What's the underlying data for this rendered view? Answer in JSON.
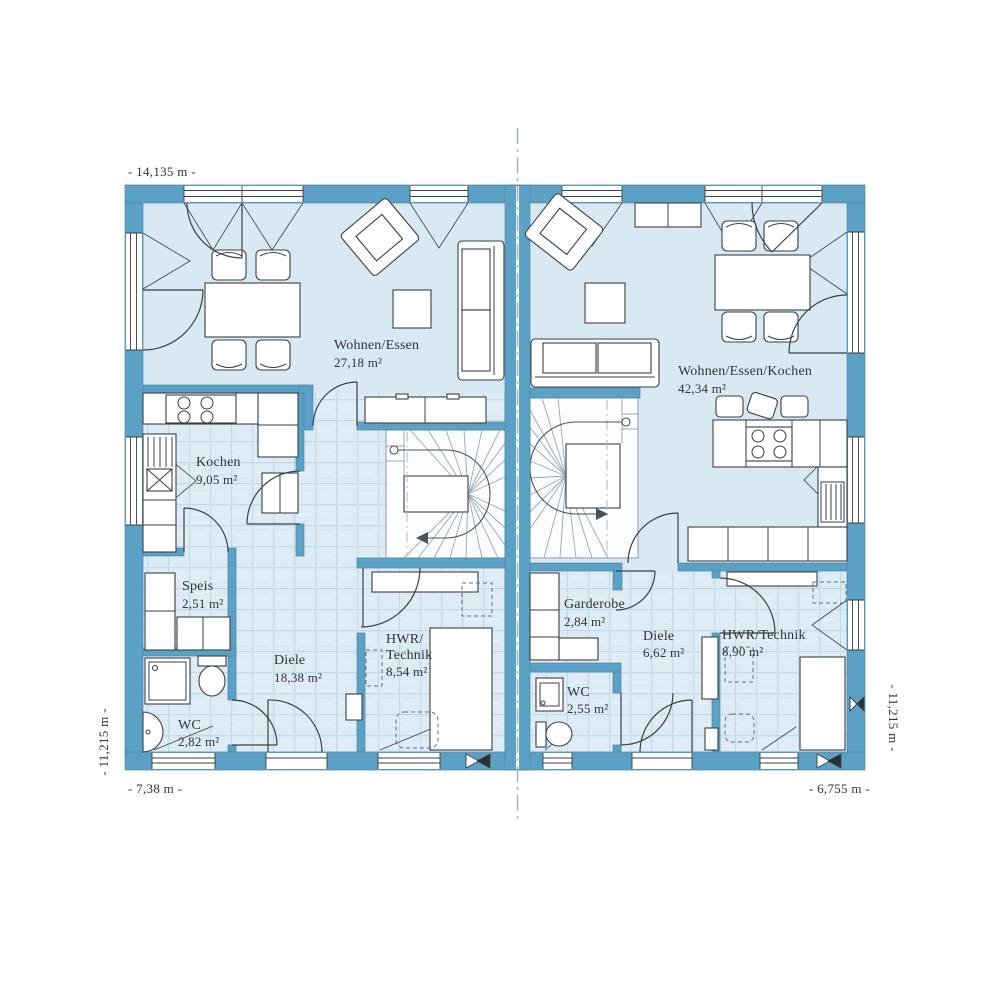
{
  "colors": {
    "wall": "#5ba1c6",
    "walledge": "#4f85a6",
    "floor": "#d9e9f3",
    "tile_line": "#c2dae8",
    "line": "#3b4044",
    "text": "#30343a"
  },
  "plan": {
    "type": "floor-plan",
    "building": "semi-detached house, ground floor, two mirrored units"
  },
  "dimensions": {
    "top": "- 14,135 m -",
    "left": "- 11,215 m -",
    "right": "- 11,215 m -",
    "bottom_left": "- 7,38 m -",
    "bottom_right": "- 6,755 m -"
  },
  "unit_left": {
    "rooms": [
      {
        "name": "Wohnen/Essen",
        "area": "27,18 m²"
      },
      {
        "name": "Kochen",
        "area": "9,05 m²"
      },
      {
        "name": "Speis",
        "area": "2,51 m²"
      },
      {
        "name": "Diele",
        "area": "18,38 m²"
      },
      {
        "name": "WC",
        "area": "2,82 m²"
      },
      {
        "name_line1": "HWR/",
        "name_line2": "Technik",
        "area": "8,54 m²"
      }
    ]
  },
  "unit_right": {
    "rooms": [
      {
        "name": "Wohnen/Essen/Kochen",
        "area": "42,34 m²"
      },
      {
        "name": "Garderobe",
        "area": "2,84 m²"
      },
      {
        "name": "Diele",
        "area": "6,62 m²"
      },
      {
        "name": "WC",
        "area": "2,55 m²"
      },
      {
        "name": "HWR/Technik",
        "area": "8,90 m²"
      }
    ]
  }
}
